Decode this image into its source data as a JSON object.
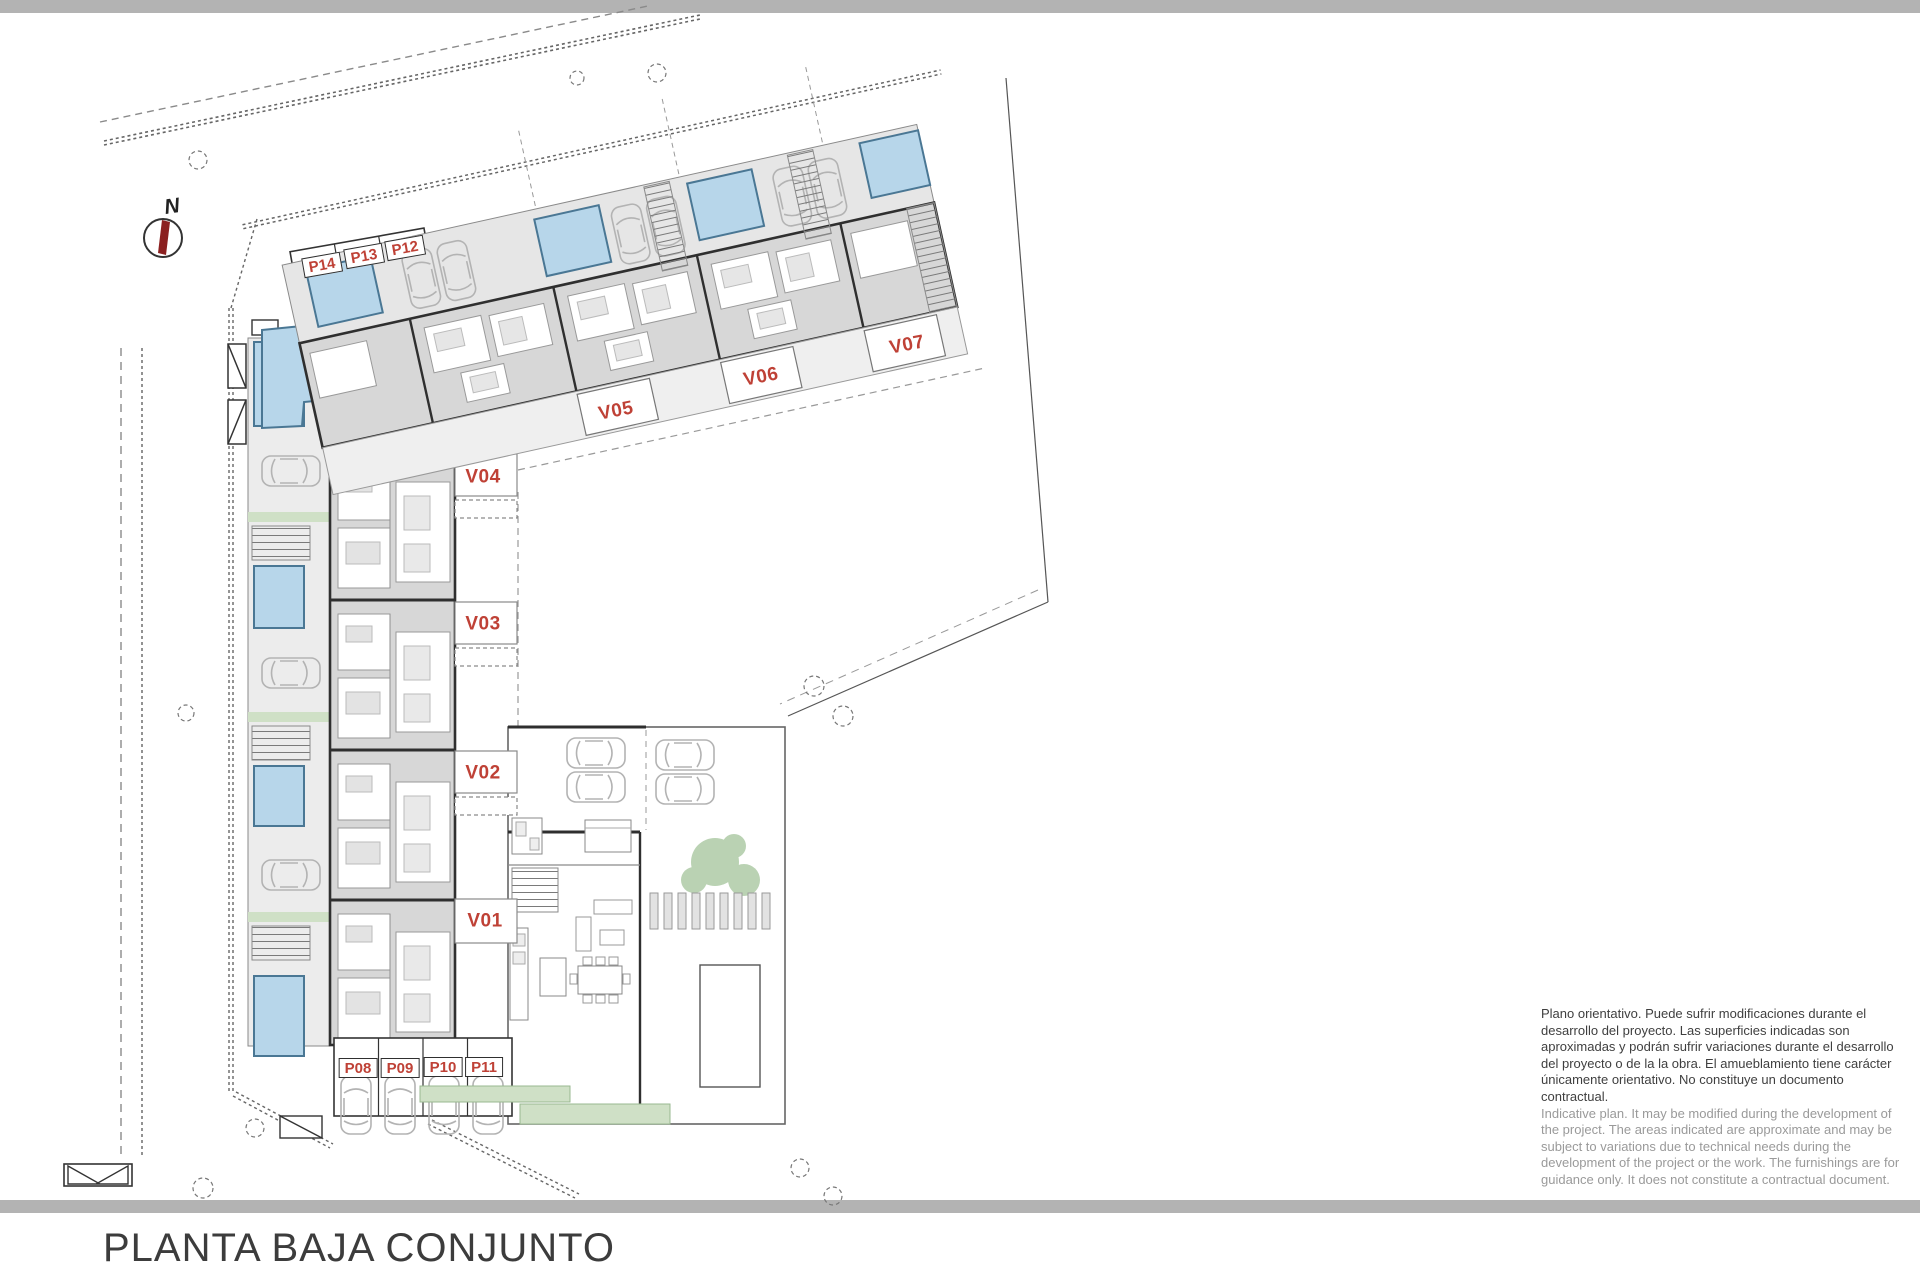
{
  "sheet": {
    "title": "PLANTA BAJA CONJUNTO",
    "north_label": "N"
  },
  "colors": {
    "accent_red": "#bf4136",
    "pool_blue": "#b7d6ea",
    "pool_edge": "#4a7794",
    "green": "#cfe0c6",
    "tree_green": "#a3c49a",
    "building_gray": "#d7d7d7",
    "wall_dark": "#2f2f2f",
    "bar_gray": "#b3b3b3"
  },
  "unit_labels": {
    "v01": "V01",
    "v02": "V02",
    "v03": "V03",
    "v04": "V04",
    "v05": "V05",
    "v06": "V06",
    "v07": "V07"
  },
  "parking_labels": {
    "p08": "P08",
    "p09": "P09",
    "p10": "P10",
    "p11": "P11",
    "p12": "P12",
    "p13": "P13",
    "p14": "P14"
  },
  "disclaimer": {
    "es": "Plano orientativo. Puede sufrir modificaciones durante el desarrollo del proyecto. Las superficies indicadas son aproximadas y podrán sufrir variaciones durante el desarrollo del proyecto o de la la obra. El amueblamiento tiene carácter únicamente orientativo. No constituye un documento contractual.",
    "en": "Indicative plan. It may be modified during the development of the project. The areas indicated are approximate and may be subject to variations due to technical needs during the development of the project or the work. The furnishings are for guidance only. It does not constitute a contractual document."
  }
}
